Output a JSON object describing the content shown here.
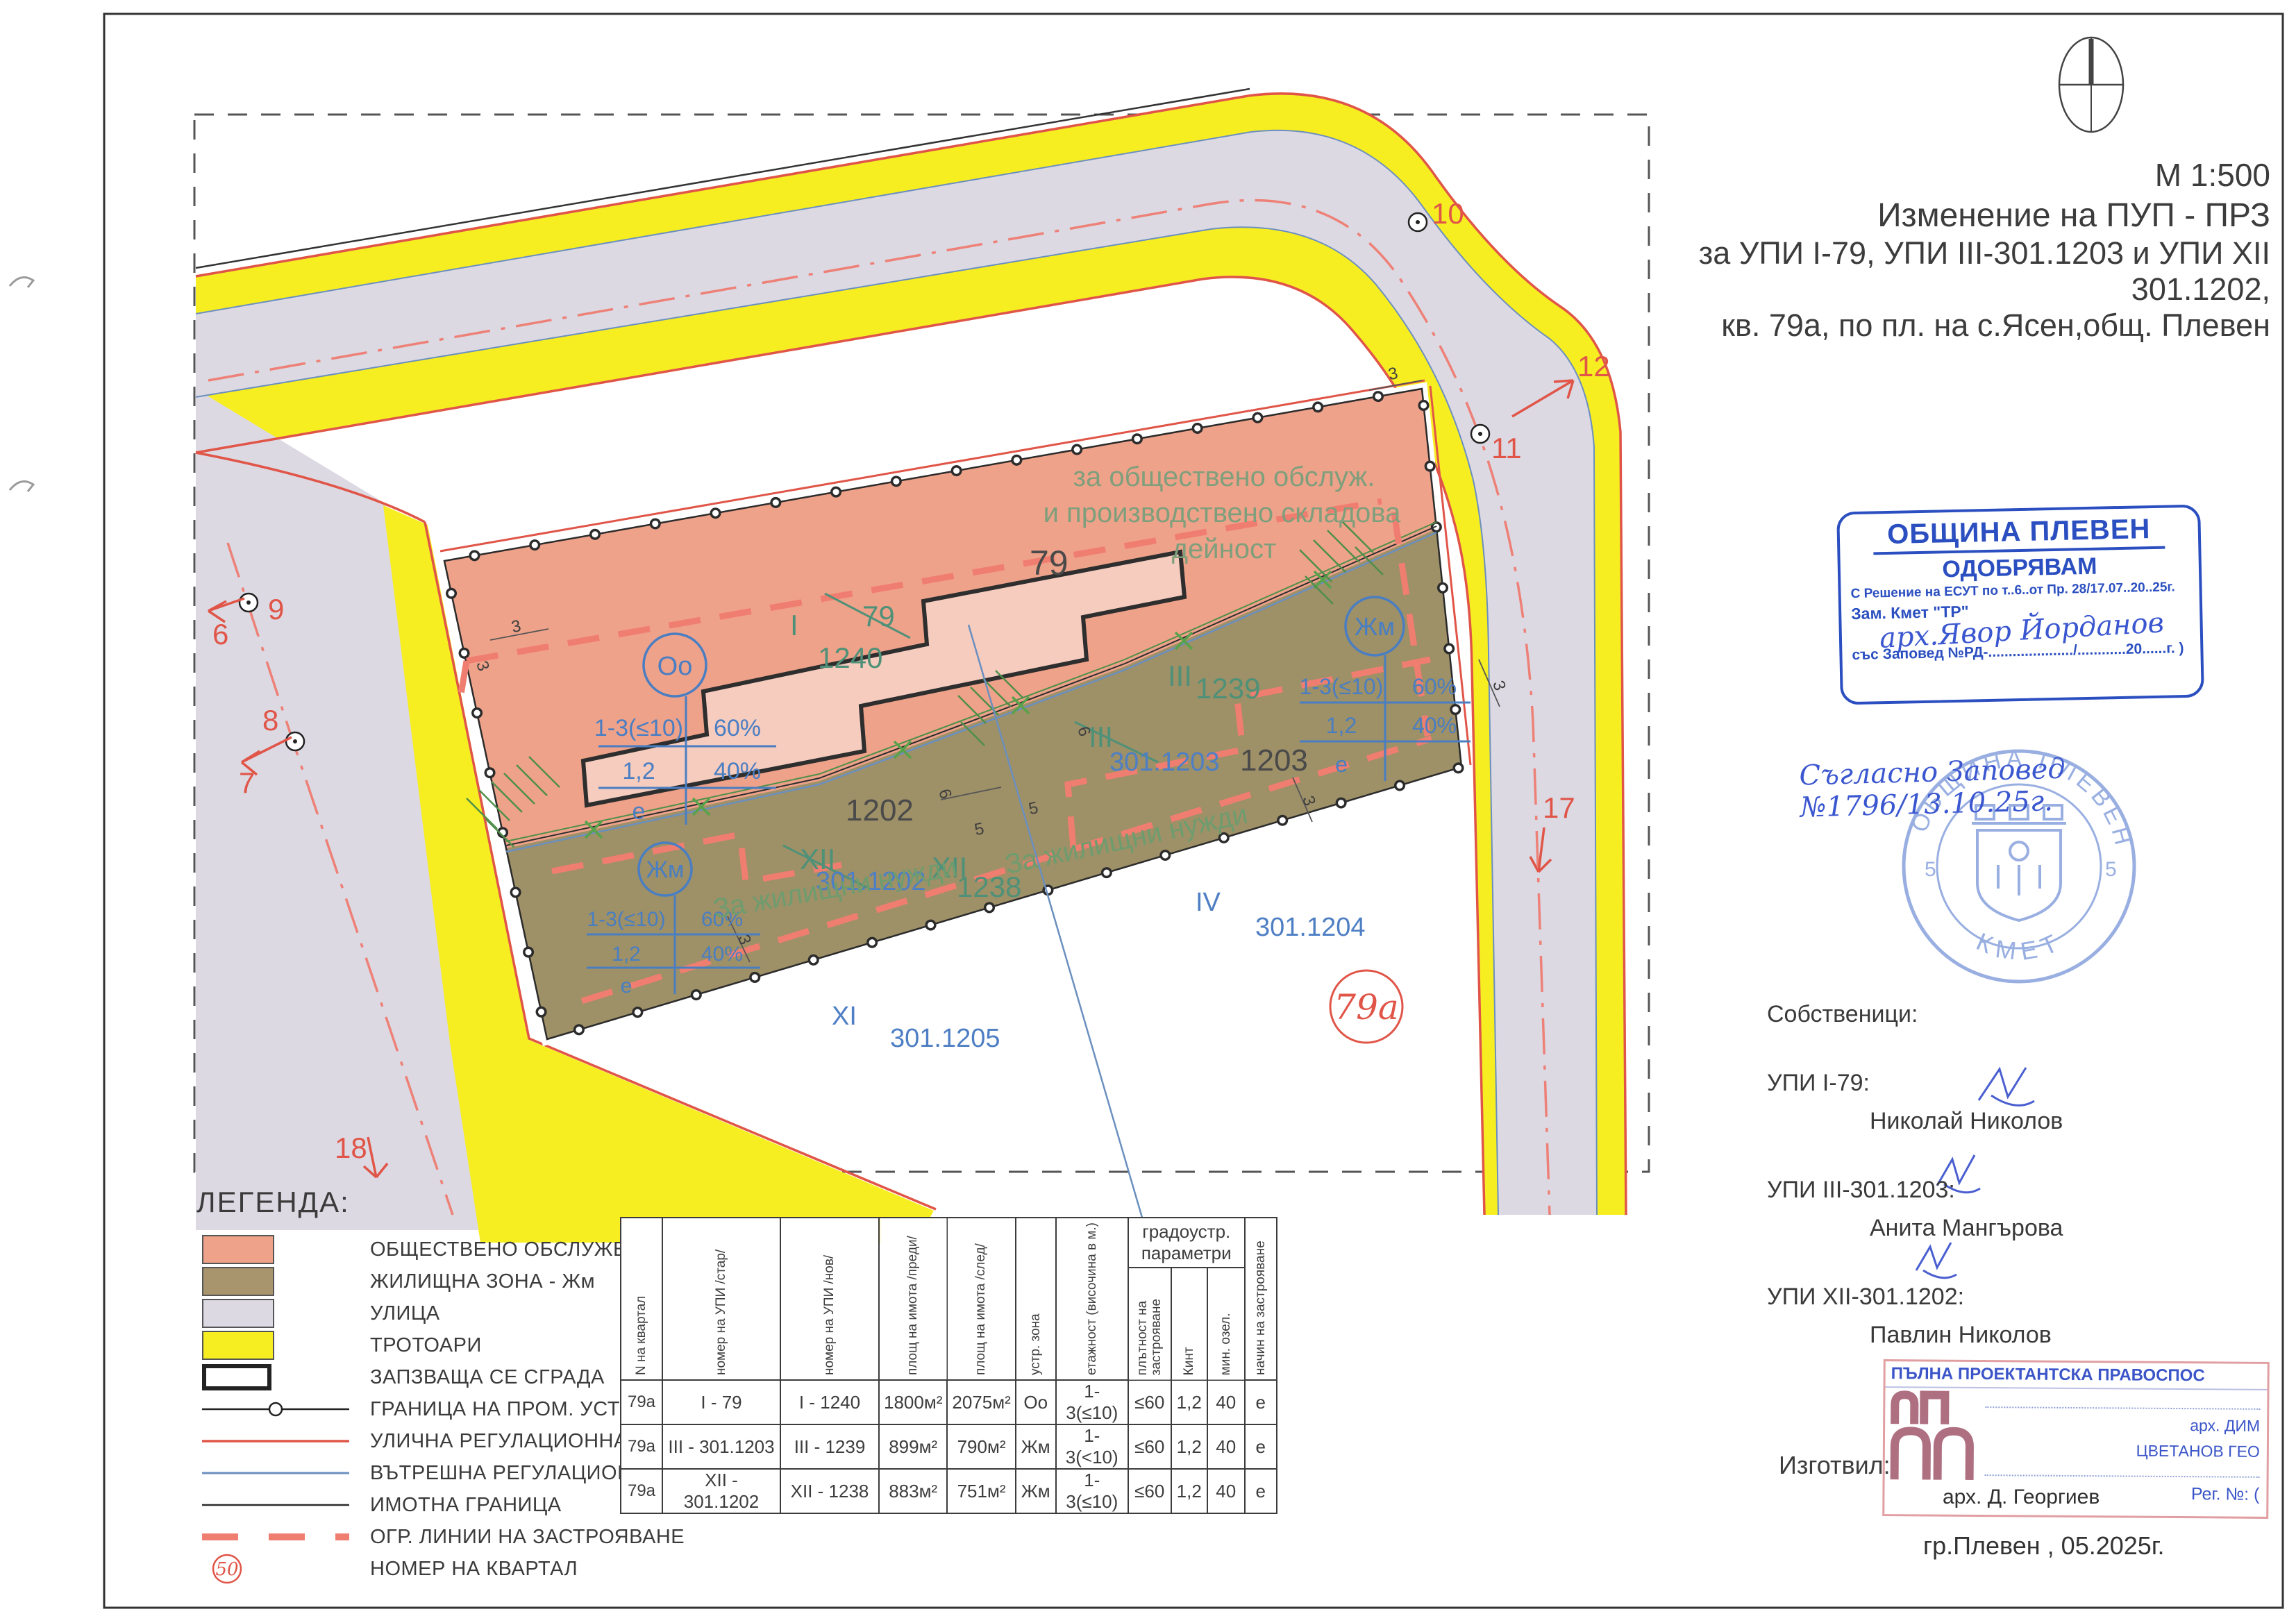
{
  "doc": {
    "scale": "М 1:500",
    "title_line1": "Изменение на ПУП - ПРЗ",
    "title_line2": "за УПИ I-79, УПИ III-301.1203 и УПИ XII 301.1202,",
    "title_line3": "кв. 79а, по пл. на с.Ясен,общ. Плевен"
  },
  "approval_stamp": {
    "org": "ОБЩИНА ПЛЕВЕН",
    "approve": "ОДОБРЯВАМ",
    "decision_line": "С Решение на ЕСУТ по т..6..от Пр. 28/17.07..20..25г.",
    "deputy": "Зам. Кмет \"ТР\"",
    "signature_name": "арх.Явор Йорданов",
    "order_line": "със Заповед №РД-...................../............20......г. )",
    "handwritten_note": "Съгласно Заповед №1796/13.10.25г."
  },
  "round_stamp": {
    "top": "ОБЩИНА ПЛЕВЕН",
    "bottom": "КМЕТ",
    "left": "5",
    "right": "5"
  },
  "owners": {
    "heading": "Собственици:",
    "items": [
      {
        "parcel": "УПИ I-79:",
        "name": "Николай Николов"
      },
      {
        "parcel": "УПИ III-301.1203:",
        "name": "Анита Мангърова"
      },
      {
        "parcel": "УПИ XII-301.1202:",
        "name": "Павлин Николов"
      }
    ]
  },
  "author": {
    "prepared_label": "Изготвил:",
    "stamp_title": "ПЪЛНА ПРОЕКТАНТСКА ПРАВОСПОС",
    "stamp_name_line1": "арх. ДИМ",
    "stamp_name_line2": "ЦВЕТАНОВ ГЕО",
    "stamp_reg": "Рег. №:  (",
    "stamp_date_label": "дата",
    "stamp_sign_label": "подпис..........",
    "architect": "арх. Д. Георгиев",
    "place_date": "гр.Плевен , 05.2025г."
  },
  "legend": {
    "heading": "ЛЕГЕНДА:",
    "items": [
      {
        "label": "ОБЩЕСТВЕНО ОБСЛУЖВАНЕ"
      },
      {
        "label": "ЖИЛИЩНА ЗОНА - Жм"
      },
      {
        "label": "УЛИЦА"
      },
      {
        "label": "ТРОТОАРИ"
      },
      {
        "label": "ЗАПЗВАЩА СЕ СГРАДА"
      },
      {
        "label": "ГРАНИЦА НА ПРОМ. УСТР. РЕЖИМ"
      },
      {
        "label": "УЛИЧНА РЕГУЛАЦИОННА ЛИНИЯ"
      },
      {
        "label": "ВЪТРЕШНА РЕГУЛАЦИОННА ЛИНИЯ"
      },
      {
        "label": "ИМОТНА ГРАНИЦА"
      },
      {
        "label": "ОГР. ЛИНИИ НА ЗАСТРОЯВАНЕ"
      },
      {
        "label": "НОМЕР НА КВАРТАЛ",
        "symbol_number": "50"
      }
    ]
  },
  "table": {
    "headers": [
      "N на квартал",
      "номер на УПИ /стар/",
      "номер на УПИ /нов/",
      "площ на имота /преди/",
      "площ на имота /след/",
      "устр. зона",
      "етажност (височина в м.)",
      "плътност на застрояване",
      "Кинт",
      "мин. озел.",
      "начин на застрояване"
    ],
    "group_header": "градоустр. параметри",
    "rows": [
      [
        "79а",
        "I - 79",
        "I - 1240",
        "1800м²",
        "2075м²",
        "Оо",
        "1-3(≤10)",
        "≤60",
        "1,2",
        "40",
        "е"
      ],
      [
        "79а",
        "III - 301.1203",
        "III - 1239",
        "899м²",
        "790м²",
        "Жм",
        "1-3(<10)",
        "≤60",
        "1,2",
        "40",
        "е"
      ],
      [
        "79а",
        "XII - 301.1202",
        "XII - 1238",
        "883м²",
        "751м²",
        "Жм",
        "1-3(≤10)",
        "≤60",
        "1,2",
        "40",
        "е"
      ]
    ]
  },
  "map": {
    "zone_note_line1": "за обществено обслуж.",
    "zone_note_line2": "и производствено складова",
    "zone_note_line3": "дейност",
    "residential_note": "За жилищни нужди",
    "labels": {
      "quarter_circle": "79а",
      "block_79": "79",
      "old_I": "I",
      "old_79": "79",
      "new_1240": "1240",
      "old_III": "III",
      "new_III": "III",
      "num_1239": "1239",
      "cad_1203": "301.1203",
      "p1203": "1203",
      "p1202": "1202",
      "old_XII": "XII",
      "new_XII": "XII",
      "num_1238": "1238",
      "cad_1202": "301.1202",
      "IV": "IV",
      "cad_1204": "301.1204",
      "XI": "XI",
      "cad_1205": "301.1205",
      "pt6": "6",
      "pt7": "7",
      "pt8": "8",
      "pt9": "9",
      "pt10": "10",
      "pt11": "11",
      "pt12": "12",
      "pt17": "17",
      "pt18": "18"
    },
    "oo_symbol": {
      "zone": "Оо",
      "r1l": "1-3(≤10)",
      "r1r": "60%",
      "r2l": "1,2",
      "r2r": "40%",
      "r3": "е"
    },
    "zhm_symbol": {
      "zone": "Жм",
      "r1l": "1-3(≤10)",
      "r1r": "60%",
      "r2l": "1,2",
      "r2r": "40%",
      "r3": "е"
    },
    "dims": {
      "d3": "3",
      "d5": "5",
      "d6": "6"
    }
  },
  "colors": {
    "public_service": "#efa28a",
    "residential": "#a8956e",
    "street": "#dcd9e3",
    "sidewalk": "#f7ee22",
    "reg_red": "#e05548",
    "dash_red": "#f07e70",
    "blue_line": "#6b8fbf",
    "label_blue": "#4e7fc4",
    "label_green": "#4f9178",
    "stamp_blue": "#2b4fc0"
  }
}
